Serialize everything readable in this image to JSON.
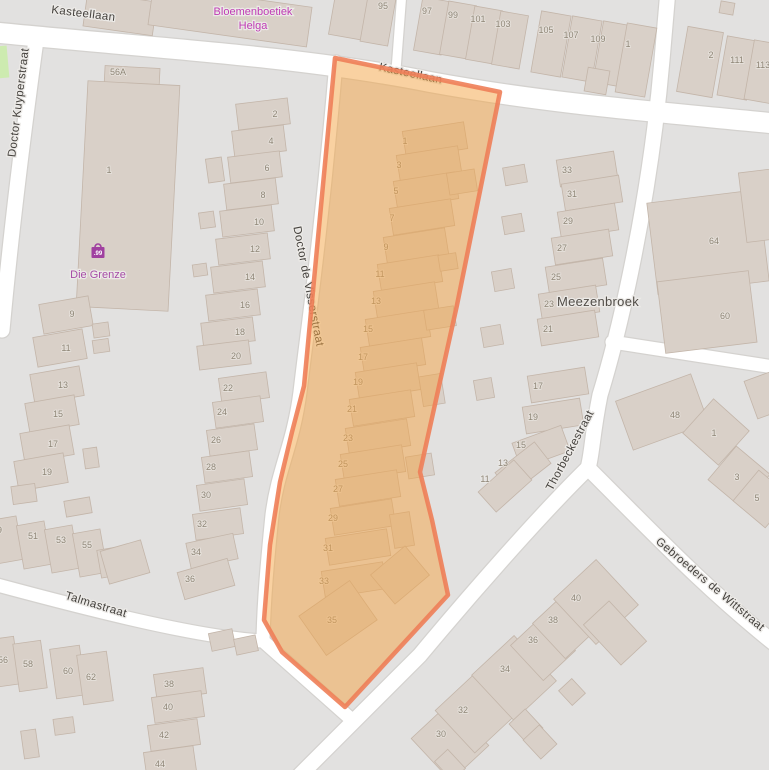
{
  "map": {
    "colors": {
      "land": "#e2e1e0",
      "road_fill": "#ffffff",
      "road_casing": "#d4d2cf",
      "building_fill": "#d9d0c8",
      "building_stroke": "#c3b5a9",
      "grass": "#cdebb0",
      "highlight_fill": "rgba(243,163,68,0.5)",
      "highlight_stroke": "#ee7e58",
      "street_text": "#45423e",
      "street_halo": "#eceae7",
      "number_text": "#8f8677",
      "number_halo": "rgba(240,238,235,0.55)",
      "place_text": "#514d48",
      "poi_magenta": "#bf3bb4",
      "poi_purple": "#a64ca6",
      "shop_icon": "#a040a0",
      "shop_badge_text": "#ffffff"
    },
    "street_labels": [
      {
        "text": "Kasteellaan",
        "x": 83,
        "y": 17,
        "rot": 7
      },
      {
        "text": "Kasteellaan",
        "x": 410,
        "y": 77,
        "rot": 12
      },
      {
        "text": "Doctor Kuyperstraat",
        "x": 22,
        "y": 103,
        "rot": -83
      },
      {
        "text": "Doctor de Visserstraat",
        "x": 305,
        "y": 287,
        "rot": 79
      },
      {
        "text": "Thorbeckestraat",
        "x": 573,
        "y": 452,
        "rot": -62
      },
      {
        "text": "Gebroeders de Wittstraat",
        "x": 708,
        "y": 587,
        "rot": 40
      },
      {
        "text": "Talmastraat",
        "x": 95,
        "y": 608,
        "rot": 17
      }
    ],
    "place_labels": [
      {
        "text": "Meezenbroek",
        "x": 598,
        "y": 302
      }
    ],
    "poi_labels": [
      {
        "text": "Bloemenboetiek",
        "x": 253,
        "y": 11,
        "color_key": "poi_magenta"
      },
      {
        "text": "Helga",
        "x": 253,
        "y": 25,
        "color_key": "poi_magenta"
      },
      {
        "text": "Die Grenze",
        "x": 98,
        "y": 274,
        "color_key": "poi_purple"
      }
    ],
    "shop_icon": {
      "x": 98,
      "y": 252,
      "badge_text": ".99"
    },
    "house_numbers": [
      [
        "95",
        383,
        6
      ],
      [
        "97",
        427,
        11
      ],
      [
        "99",
        453,
        15
      ],
      [
        "101",
        478,
        19
      ],
      [
        "103",
        503,
        24
      ],
      [
        "105",
        546,
        30
      ],
      [
        "107",
        571,
        35
      ],
      [
        "109",
        598,
        39
      ],
      [
        "1",
        628,
        44
      ],
      [
        "2",
        711,
        55
      ],
      [
        "111",
        737,
        60
      ],
      [
        "113",
        763,
        65
      ],
      [
        "56A",
        118,
        72
      ],
      [
        "2",
        275,
        114
      ],
      [
        "4",
        271,
        141
      ],
      [
        "6",
        267,
        168
      ],
      [
        "8",
        263,
        195
      ],
      [
        "10",
        259,
        222
      ],
      [
        "12",
        255,
        249
      ],
      [
        "14",
        250,
        277
      ],
      [
        "16",
        245,
        305
      ],
      [
        "18",
        240,
        332
      ],
      [
        "20",
        236,
        356
      ],
      [
        "1",
        109,
        170
      ],
      [
        "9",
        72,
        314
      ],
      [
        "11",
        66,
        348
      ],
      [
        "13",
        63,
        385
      ],
      [
        "15",
        58,
        414
      ],
      [
        "17",
        53,
        444
      ],
      [
        "19",
        47,
        472
      ],
      [
        "49",
        -3,
        530
      ],
      [
        "51",
        33,
        536
      ],
      [
        "53",
        61,
        540
      ],
      [
        "55",
        87,
        545
      ],
      [
        "22",
        228,
        388
      ],
      [
        "24",
        222,
        412
      ],
      [
        "26",
        216,
        440
      ],
      [
        "28",
        211,
        467
      ],
      [
        "30",
        206,
        495
      ],
      [
        "32",
        202,
        524
      ],
      [
        "34",
        196,
        552
      ],
      [
        "36",
        190,
        579
      ],
      [
        "56",
        3,
        660
      ],
      [
        "58",
        28,
        664
      ],
      [
        "60",
        68,
        671
      ],
      [
        "62",
        91,
        677
      ],
      [
        "38",
        169,
        684
      ],
      [
        "40",
        168,
        707
      ],
      [
        "42",
        164,
        735
      ],
      [
        "44",
        160,
        764
      ],
      [
        "1",
        405,
        141
      ],
      [
        "3",
        399,
        165
      ],
      [
        "5",
        396,
        191
      ],
      [
        "7",
        392,
        218
      ],
      [
        "9",
        386,
        247
      ],
      [
        "11",
        380,
        274
      ],
      [
        "13",
        376,
        301
      ],
      [
        "15",
        368,
        329
      ],
      [
        "17",
        363,
        357
      ],
      [
        "19",
        358,
        382
      ],
      [
        "21",
        352,
        409
      ],
      [
        "23",
        348,
        438
      ],
      [
        "25",
        343,
        464
      ],
      [
        "27",
        338,
        489
      ],
      [
        "29",
        333,
        518
      ],
      [
        "31",
        328,
        548
      ],
      [
        "33",
        324,
        581
      ],
      [
        "35",
        332,
        620
      ],
      [
        "33",
        567,
        170
      ],
      [
        "31",
        572,
        194
      ],
      [
        "29",
        568,
        221
      ],
      [
        "27",
        562,
        248
      ],
      [
        "25",
        556,
        277
      ],
      [
        "23",
        549,
        304
      ],
      [
        "21",
        548,
        329
      ],
      [
        "17",
        538,
        386
      ],
      [
        "19",
        533,
        417
      ],
      [
        "15",
        521,
        445
      ],
      [
        "13",
        503,
        463
      ],
      [
        "11",
        485,
        479
      ],
      [
        "64",
        714,
        241
      ],
      [
        "60",
        725,
        316
      ],
      [
        "48",
        675,
        415
      ],
      [
        "1",
        714,
        433
      ],
      [
        "3",
        737,
        477
      ],
      [
        "5",
        757,
        498
      ],
      [
        "40",
        576,
        598
      ],
      [
        "38",
        553,
        620
      ],
      [
        "36",
        533,
        640
      ],
      [
        "34",
        505,
        669
      ],
      [
        "32",
        463,
        710
      ],
      [
        "30",
        441,
        734
      ]
    ]
  }
}
